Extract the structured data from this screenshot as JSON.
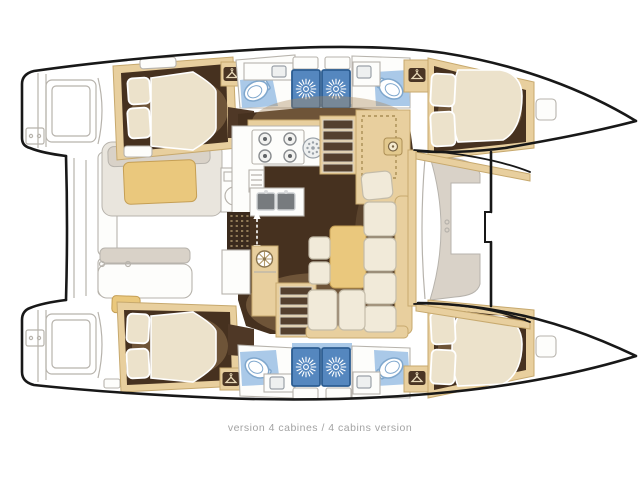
{
  "caption": {
    "text": "version 4 cabines / 4 cabins version"
  },
  "colors": {
    "outline": "#181818",
    "line-gray": "#b7b3ac",
    "greige": "#d9d2c8",
    "beige": "#e8cf9e",
    "beige-border": "#c7a96e",
    "tan": "#eac87d",
    "tan-border": "#c59f55",
    "floor-dark": "#46311f",
    "floor-overlay": "#a98a5f",
    "cream": "#ece2cb",
    "cream-border": "#c4bca9",
    "sofa-cream": "#f1ead9",
    "shower-blue": "#5587bf",
    "shower-border": "#2c5d92",
    "bath-blue": "#aac9e8",
    "toilet-border": "#7fa7cd",
    "steel": "#777b7e",
    "step-brown": "#54402e",
    "step-border": "#d8d3c8",
    "icon-brown": "#4a3524",
    "icon-glyph": "#e8d9b8",
    "caption-gray": "#a3a3a3"
  },
  "diagram": {
    "type": "catamaran floor plan, top view, bow pointing right",
    "features": [
      "port hull: aft double cabin, aft bathroom, two shower stalls, forward bathroom, forward double cabin",
      "starboard hull: aft double cabin, aft bathroom, two shower stalls, forward bathroom, forward double cabin",
      "salon: galley with stove, round sink, fridge, double sink, L-shaped sofa, table, two ottomans",
      "two companionway stairs, aft cockpit with bench and table, forward cockpit seat, trampoline area"
    ],
    "icons": [
      "sun-shower-icon (x4)",
      "hanger-wardrobe-icon (x4)",
      "wheel-vent-icon",
      "stove-burners-icon",
      "companionway-arrow-icon"
    ]
  }
}
